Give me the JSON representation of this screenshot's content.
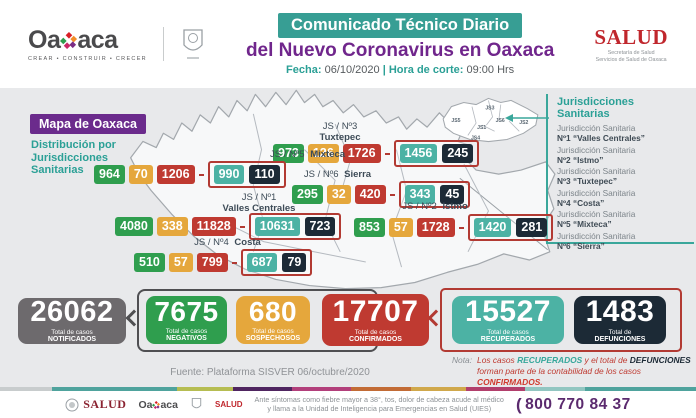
{
  "colors": {
    "teal_banner": "#379e94",
    "purple": "#70268c",
    "badge_purple": "#6b2b8c",
    "green": "#2f9e4e",
    "amber": "#e5a73c",
    "red": "#bf3a31",
    "teal_chip": "#4cb2a4",
    "navy": "#1c2a36",
    "gray_box": "#6d6a6d"
  },
  "header": {
    "oaxaca_logo": {
      "part1": "Oa",
      "part2": "aca",
      "tagline": "CREAR • CONSTRUIR • CRECER"
    },
    "banner": "Comunicado Técnico Diario",
    "title": "del Nuevo Coronavirus en Oaxaca",
    "fecha_label": "Fecha:",
    "fecha_value": "06/10/2020",
    "separator": "|",
    "hora_label": "Hora de corte:",
    "hora_value": "09:00 Hrs",
    "salud_logo": {
      "name": "SALUD",
      "sub1": "Secretaría de Salud",
      "sub2": "Servicios de Salud de Oaxaca"
    }
  },
  "map": {
    "badge": "Mapa de Oaxaca",
    "subtitle_line1": "Distribución por",
    "subtitle_line2": "Jurisdicciones",
    "subtitle_line3": "Sanitarias",
    "regions": [
      {
        "num": "JS / Nº3",
        "name": "Tuxtepec",
        "negativos": "973",
        "sospechosos": "126",
        "confirmados": "1726",
        "recuperados": "1456",
        "defunciones": "245"
      },
      {
        "num": "JS / Nº5",
        "name": "Mixteca",
        "negativos": "964",
        "sospechosos": "70",
        "confirmados": "1206",
        "recuperados": "990",
        "defunciones": "110"
      },
      {
        "num": "JS / Nº6",
        "name": "Sierra",
        "negativos": "295",
        "sospechosos": "32",
        "confirmados": "420",
        "recuperados": "343",
        "defunciones": "45"
      },
      {
        "num": "JS / Nº1",
        "name": "Valles Centrales",
        "negativos": "4080",
        "sospechosos": "338",
        "confirmados": "11828",
        "recuperados": "10631",
        "defunciones": "723"
      },
      {
        "num": "JS / Nº2",
        "name": "Istmo",
        "negativos": "853",
        "sospechosos": "57",
        "confirmados": "1728",
        "recuperados": "1420",
        "defunciones": "281"
      },
      {
        "num": "JS / Nº4",
        "name": "Costa",
        "negativos": "510",
        "sospechosos": "57",
        "confirmados": "799",
        "recuperados": "687",
        "defunciones": "79"
      }
    ],
    "minimap_labels": [
      "JS5",
      "JS3",
      "JS1",
      "JS6",
      "JS2",
      "JS4"
    ]
  },
  "legend": {
    "title_line1": "Jurisdicciones",
    "title_line2": "Sanitarias",
    "items": [
      {
        "line1": "Jurisdicción Sanitaria",
        "line2": "Nº1 “Valles Centrales”"
      },
      {
        "line1": "Jurisdicción Sanitaria",
        "line2": "Nº2 “Istmo”"
      },
      {
        "line1": "Jurisdicción Sanitaria",
        "line2": "Nº3 “Tuxtepec”"
      },
      {
        "line1": "Jurisdicción Sanitaria",
        "line2": "Nº4 “Costa”"
      },
      {
        "line1": "Jurisdicción Sanitaria",
        "line2": "Nº5 “Mixteca”"
      },
      {
        "line1": "Jurisdicción Sanitaria",
        "line2": "Nº6 “Sierra”"
      }
    ]
  },
  "totals": [
    {
      "value": "26062",
      "label1": "Total de casos",
      "label2": "NOTIFICADOS"
    },
    {
      "value": "7675",
      "label1": "Total de casos",
      "label2": "NEGATIVOS"
    },
    {
      "value": "680",
      "label1": "Total de casos",
      "label2": "SOSPECHOSOS"
    },
    {
      "value": "17707",
      "label1": "Total de casos",
      "label2": "CONFIRMADOS"
    },
    {
      "value": "15527",
      "label1": "Total de casos",
      "label2": "RECUPERADOS"
    },
    {
      "value": "1483",
      "label1": "Total de",
      "label2": "DEFUNCIONES"
    }
  ],
  "fuente": "Fuente: Plataforma SISVER 06/octubre/2020",
  "nota": {
    "label": "Nota:",
    "seg1": "Los casos ",
    "seg2": "RECUPERADOS",
    "seg3": " y el total de ",
    "seg4": "DEFUNCIONES",
    "seg5": " forman parte de la contabilidad de los casos ",
    "seg6": "CONFIRMADOS."
  },
  "footer": {
    "salud_gov": "SALUD",
    "oaxaca_part1": "Oa",
    "oaxaca_part2": "aca",
    "salud_state": "SALUD",
    "message_line1": "Ante síntomas como fiebre mayor a 38°, tos, dolor de cabeza acude al médico",
    "message_line2": "y llama a la Unidad de Inteligencia para Emergencias en Salud (UIES)",
    "phone": "800 770 84 37"
  }
}
